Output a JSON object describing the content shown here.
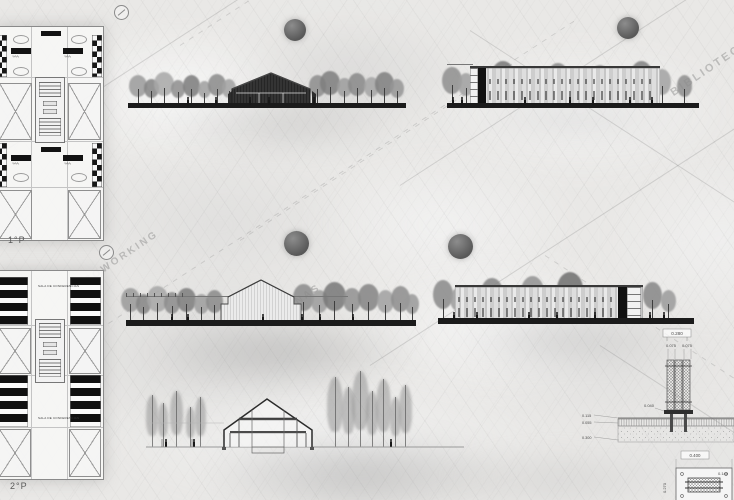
{
  "plans": {
    "plan1_label": "1°P",
    "plan2_label": "2°P",
    "conference_room_label_upper": "SALA DE CONFERENCIAS",
    "conference_room_label_lower": "SALA DE CONFERENCIAS",
    "amenity_squiggle": "∿∿∿"
  },
  "background_labels": {
    "library": "BIBLIOTECA",
    "coworking": "COWORKING",
    "offices": "OFICINAS"
  },
  "construction_detail": {
    "dim_column_overall": "0.280",
    "dim_post_left": "0.075",
    "dim_post_right": "0.075",
    "dim_base_plate": "0.040",
    "level_screed": "0.115",
    "level_slab": "0.055",
    "level_foundation": "0.300",
    "plan_dim_width": "0.400",
    "plan_dim_height": "0.140",
    "plan_dim_depth": "0.270"
  },
  "colors": {
    "ground_line": "#1b1b1b",
    "dark_building": "#333333",
    "panel_light": "#d9d9d9",
    "sun_marker": "#606060"
  }
}
